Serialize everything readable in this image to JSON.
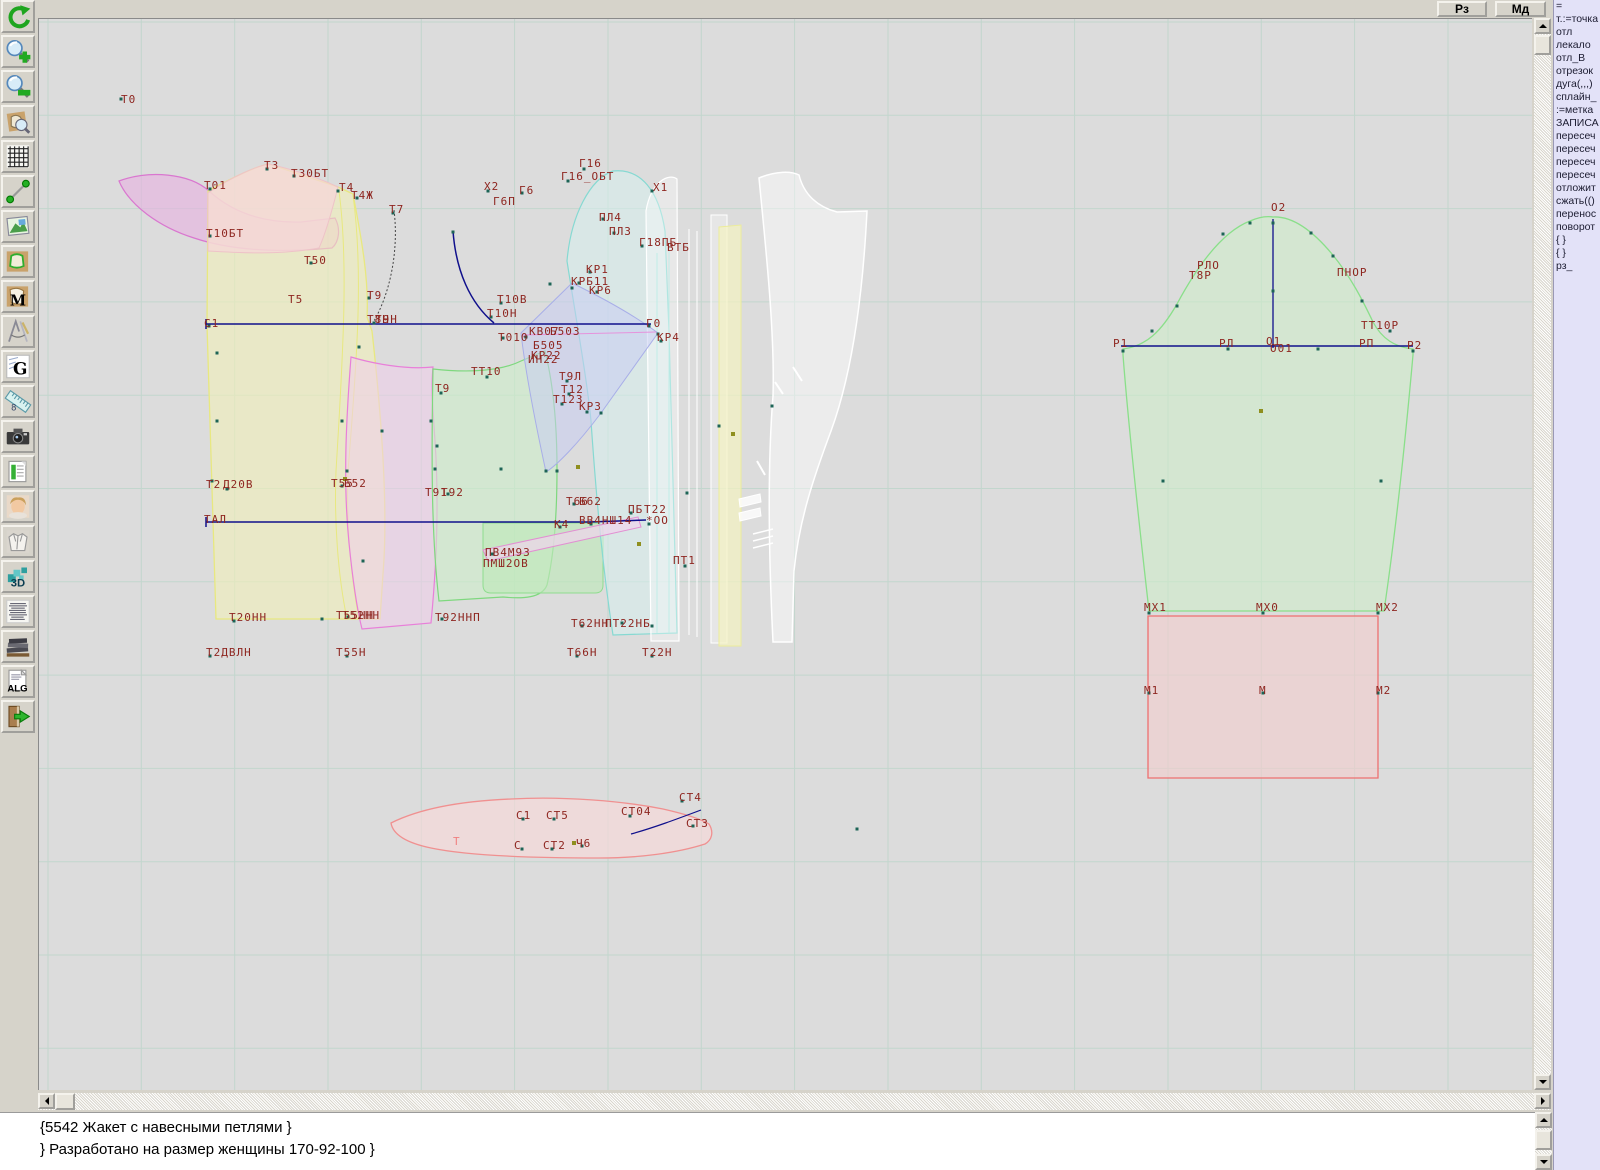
{
  "topbar": {
    "buttons": [
      {
        "label": "Рз"
      },
      {
        "label": "Мд"
      }
    ]
  },
  "toolbar": {
    "icons": [
      {
        "name": "undo",
        "glyph": ""
      },
      {
        "name": "zoom-in",
        "glyph": ""
      },
      {
        "name": "zoom-out",
        "glyph": ""
      },
      {
        "name": "piece-preview",
        "glyph": ""
      },
      {
        "name": "grid",
        "glyph": ""
      },
      {
        "name": "line-tool",
        "glyph": ""
      },
      {
        "name": "image",
        "glyph": ""
      },
      {
        "name": "pattern-piece",
        "glyph": ""
      },
      {
        "name": "pattern-m",
        "glyph": "M"
      },
      {
        "name": "drafting",
        "glyph": ""
      },
      {
        "name": "graphics-g",
        "glyph": "G"
      },
      {
        "name": "ruler",
        "glyph": "8"
      },
      {
        "name": "camera",
        "glyph": ""
      },
      {
        "name": "table",
        "glyph": ""
      },
      {
        "name": "model-photo",
        "glyph": ""
      },
      {
        "name": "garment",
        "glyph": ""
      },
      {
        "name": "view-3d",
        "glyph": "3D"
      },
      {
        "name": "text-list",
        "glyph": ""
      },
      {
        "name": "archive-books",
        "glyph": ""
      },
      {
        "name": "algorithm",
        "glyph": "ALG"
      },
      {
        "name": "exit",
        "glyph": ""
      }
    ]
  },
  "command_panel": {
    "items": [
      "=",
      "т.:=точка",
      "отл",
      "лекало",
      "отл_В",
      "отрезок",
      "дуга(,,,)",
      "сплайн_",
      ":=метка",
      "ЗАПИСА",
      "пересеч",
      "пересеч",
      "пересеч",
      "пересеч",
      "отложит",
      "сжать(()",
      "перенос",
      "поворот",
      "{  }",
      "{  }",
      "рз_"
    ]
  },
  "status": {
    "lines": [
      "{5542 Жакет с навесными петлями }",
      "} Разработано на размер женщины 170-92-100 }"
    ]
  },
  "canvas": {
    "colors": {
      "background": "#dcdcdc",
      "grid": "#c2d6cd",
      "label": "#8e2620",
      "construction_line": "#10108c",
      "point": "#1d6456",
      "point_alt": "#8f8f1f",
      "panel_bg": "#e3e2f8",
      "chrome": "#d6d3ca"
    },
    "labels": [
      {
        "t": "Т0",
        "x": 120,
        "y": 92
      },
      {
        "t": "Т3",
        "x": 263,
        "y": 158
      },
      {
        "t": "Т30БТ",
        "x": 290,
        "y": 166
      },
      {
        "t": "Т01",
        "x": 203,
        "y": 178
      },
      {
        "t": "Т4",
        "x": 338,
        "y": 180
      },
      {
        "t": "Т4Ж",
        "x": 350,
        "y": 188
      },
      {
        "t": "Т7",
        "x": 388,
        "y": 202
      },
      {
        "t": "Т10БТ",
        "x": 205,
        "y": 226
      },
      {
        "t": "Т50",
        "x": 303,
        "y": 253
      },
      {
        "t": "Т5",
        "x": 287,
        "y": 292
      },
      {
        "t": "Т9",
        "x": 366,
        "y": 288
      },
      {
        "t": "Т8Н",
        "x": 366,
        "y": 312
      },
      {
        "t": "Т9Н",
        "x": 374,
        "y": 312
      },
      {
        "t": "С1",
        "x": 203,
        "y": 316
      },
      {
        "t": "Х2",
        "x": 483,
        "y": 179
      },
      {
        "t": "Г6",
        "x": 518,
        "y": 183
      },
      {
        "t": "Г6П",
        "x": 492,
        "y": 194
      },
      {
        "t": "Г16",
        "x": 578,
        "y": 156
      },
      {
        "t": "Г16_ОБТ",
        "x": 560,
        "y": 169
      },
      {
        "t": "Х1",
        "x": 652,
        "y": 180
      },
      {
        "t": "ПЛ4",
        "x": 598,
        "y": 210
      },
      {
        "t": "ПЛ3",
        "x": 608,
        "y": 224
      },
      {
        "t": "Г18ПБ",
        "x": 638,
        "y": 235
      },
      {
        "t": "ВТБ",
        "x": 666,
        "y": 240
      },
      {
        "t": "КР1",
        "x": 585,
        "y": 262
      },
      {
        "t": "КРБ11",
        "x": 570,
        "y": 274
      },
      {
        "t": "КР6",
        "x": 588,
        "y": 283
      },
      {
        "t": "Т10В",
        "x": 496,
        "y": 292
      },
      {
        "t": "Т10Н",
        "x": 486,
        "y": 306
      },
      {
        "t": "Т010",
        "x": 497,
        "y": 330
      },
      {
        "t": "КВ07",
        "x": 528,
        "y": 324
      },
      {
        "t": "Б503",
        "x": 549,
        "y": 324
      },
      {
        "t": "Б505",
        "x": 532,
        "y": 338
      },
      {
        "t": "КР22",
        "x": 530,
        "y": 348
      },
      {
        "t": "ИН22",
        "x": 527,
        "y": 352
      },
      {
        "t": "Г0",
        "x": 645,
        "y": 316
      },
      {
        "t": "КР4",
        "x": 656,
        "y": 330
      },
      {
        "t": "ТТ10",
        "x": 470,
        "y": 364
      },
      {
        "t": "Т9",
        "x": 434,
        "y": 381
      },
      {
        "t": "Т9Л",
        "x": 558,
        "y": 369
      },
      {
        "t": "Т12",
        "x": 560,
        "y": 382
      },
      {
        "t": "Т123",
        "x": 552,
        "y": 392
      },
      {
        "t": "КР3",
        "x": 578,
        "y": 399
      },
      {
        "t": "Т2",
        "x": 205,
        "y": 477
      },
      {
        "t": "Д20В",
        "x": 222,
        "y": 477
      },
      {
        "t": "Т55",
        "x": 330,
        "y": 476
      },
      {
        "t": "Б52",
        "x": 343,
        "y": 476
      },
      {
        "t": "Т91",
        "x": 424,
        "y": 485
      },
      {
        "t": "Т92",
        "x": 440,
        "y": 485
      },
      {
        "t": "ТАЛ",
        "x": 203,
        "y": 512
      },
      {
        "t": "Т66",
        "x": 565,
        "y": 494
      },
      {
        "t": "Б62",
        "x": 578,
        "y": 494
      },
      {
        "t": "ПБ",
        "x": 627,
        "y": 502
      },
      {
        "t": "Т22",
        "x": 643,
        "y": 502
      },
      {
        "t": "К4",
        "x": 553,
        "y": 517
      },
      {
        "t": "ВВ4НШ14",
        "x": 578,
        "y": 513
      },
      {
        "t": "*ОО",
        "x": 645,
        "y": 513
      },
      {
        "t": "ПВ4М93",
        "x": 484,
        "y": 545
      },
      {
        "t": "ПМШ2ОВ",
        "x": 482,
        "y": 556
      },
      {
        "t": "ПТ1",
        "x": 672,
        "y": 553
      },
      {
        "t": "Т20НН",
        "x": 228,
        "y": 610
      },
      {
        "t": "Т55НН",
        "x": 335,
        "y": 608
      },
      {
        "t": "Т52НН",
        "x": 341,
        "y": 608
      },
      {
        "t": "Т92ННП",
        "x": 434,
        "y": 610
      },
      {
        "t": "Т62НН",
        "x": 570,
        "y": 616
      },
      {
        "t": "ПТ22НБ",
        "x": 604,
        "y": 616
      },
      {
        "t": "Т2ДВЛН",
        "x": 205,
        "y": 645
      },
      {
        "t": "Т55Н",
        "x": 335,
        "y": 645
      },
      {
        "t": "Т66Н",
        "x": 566,
        "y": 645
      },
      {
        "t": "Т22Н",
        "x": 641,
        "y": 645
      },
      {
        "t": "С1",
        "x": 515,
        "y": 808
      },
      {
        "t": "СТ5",
        "x": 545,
        "y": 808
      },
      {
        "t": "СТ04",
        "x": 620,
        "y": 804
      },
      {
        "t": "СТ4",
        "x": 678,
        "y": 790
      },
      {
        "t": "СТ3",
        "x": 685,
        "y": 816
      },
      {
        "t": "С",
        "x": 513,
        "y": 838
      },
      {
        "t": "СТ2",
        "x": 542,
        "y": 838
      },
      {
        "t": "Ч6",
        "x": 575,
        "y": 836
      },
      {
        "t": "Т",
        "x": 452,
        "y": 834,
        "c": "#f08080"
      },
      {
        "t": "О2",
        "x": 1270,
        "y": 200
      },
      {
        "t": "РЛО",
        "x": 1196,
        "y": 258
      },
      {
        "t": "Т8Р",
        "x": 1188,
        "y": 268
      },
      {
        "t": "ПНОР",
        "x": 1336,
        "y": 265
      },
      {
        "t": "ТТ10Р",
        "x": 1360,
        "y": 318
      },
      {
        "t": "Р1",
        "x": 1112,
        "y": 336
      },
      {
        "t": "РЛ",
        "x": 1218,
        "y": 336
      },
      {
        "t": "О1",
        "x": 1265,
        "y": 334
      },
      {
        "t": "О01",
        "x": 1269,
        "y": 341
      },
      {
        "t": "РП",
        "x": 1358,
        "y": 336
      },
      {
        "t": "Р2",
        "x": 1406,
        "y": 338
      },
      {
        "t": "МХ1",
        "x": 1143,
        "y": 600
      },
      {
        "t": "МХ0",
        "x": 1255,
        "y": 600
      },
      {
        "t": "МХ2",
        "x": 1375,
        "y": 600
      },
      {
        "t": "М1",
        "x": 1143,
        "y": 683
      },
      {
        "t": "М",
        "x": 1258,
        "y": 683
      },
      {
        "t": "М2",
        "x": 1375,
        "y": 683
      }
    ]
  }
}
